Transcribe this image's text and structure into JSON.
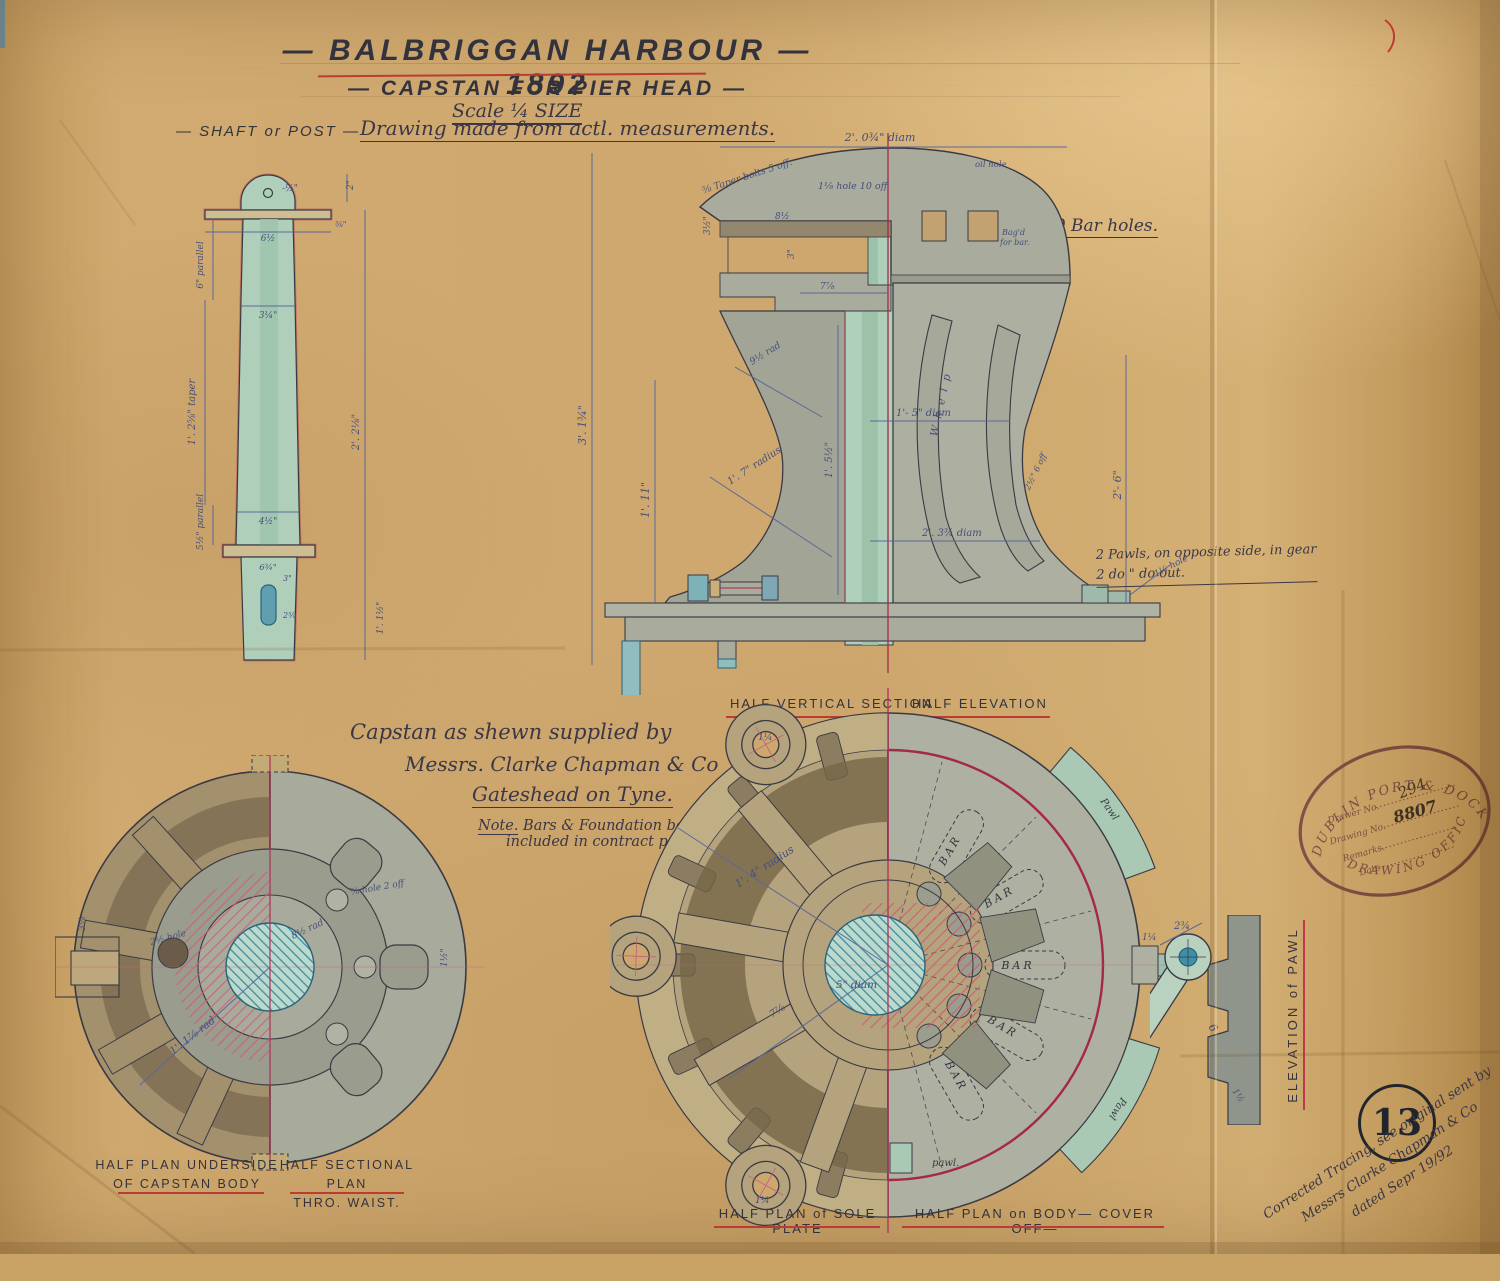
{
  "title_block": {
    "title": "— BALBRIGGAN  HARBOUR — 1892",
    "subtitle": "— CAPSTAN  FOR  PIER  HEAD —",
    "scale": "Scale ¼ SIZE"
  },
  "header": {
    "shaft_heading": "— SHAFT  or  POST —",
    "measurement_note": "Drawing made from actl. measurements.",
    "bar_holes": "10 Bar holes."
  },
  "shaft_view": {
    "dims": {
      "hole": "-½\"",
      "collar_width": "6½",
      "collar_thk": "⅜\"",
      "head_height": "2\"",
      "parallel_top": "6\" parallel",
      "dia_top": "3¼\"",
      "taper_length": "1'. 2⅝\" taper",
      "overall": "2'. 2⅛\"",
      "dia_bottom": "4½\"",
      "parallel_bottom": "5½\" parallel",
      "collar2_width": "6¾\"",
      "cotter_offset": "3\"",
      "cotter": "2⅝",
      "tail": "1'. 1½\""
    }
  },
  "section_view": {
    "label_left": "HALF VERTICAL SECTION",
    "label_right": "HALF ELEVATION",
    "ann": {
      "taper_bolts": "⅝ Taper bolts 5 off.",
      "hole10": "1⅛ hole 10 off",
      "oil_hole": "oil hole",
      "top_dia": "2'. 0¾\" diam",
      "plate": "8½",
      "chamber": "3\"",
      "lip": "3½\"",
      "depth": "7⅞",
      "bagd1": "Bag'd",
      "bagd2": "for bar.",
      "rad_waist": "9½ rad",
      "height_inner": "1'. 11\"",
      "height_overall": "3'. 1¾\"",
      "core": "1'. 5½\"",
      "dia_waist": "1'- 5\" diam",
      "whelp": "W h e l p",
      "whelp_w": "2½\" 6 off",
      "dia_base": "2'. 3¾ diam",
      "height_right": "2'- 6\"",
      "rad_base": "1'. 7\" radius",
      "hole_base": "1¼ hole",
      "pawls_line1": "2 Pawls, on opposite side, in gear",
      "pawls_line2": "2   do          \"          do   out."
    }
  },
  "supplier_note": {
    "line1": "Capstan as shewn supplied by",
    "line2": "Messrs. Clarke Chapman & Co",
    "line3": "Gateshead on Tyne.",
    "note_label": "Note.",
    "note_line1": " Bars & Foundation bolts not",
    "note_line2": "included in contract price."
  },
  "underside_plan": {
    "label_line1": "HALF PLAN UNDERSIDE",
    "label_line2": "OF CAPSTAN BODY",
    "label2_line1": "HALF SECTIONAL PLAN",
    "label2_line2": "THRO. WAIST.",
    "ann": {
      "hole_dark": "2½ hole",
      "hole2": "⅞ hole 2 off",
      "rad_outer": "1'. 1⅞ rad",
      "rad_inner": "8½ rad",
      "slot": "1½\"",
      "boss": "3⅛"
    }
  },
  "sole_plan": {
    "label_left": "HALF PLAN of SOLE PLATE",
    "label_right": "HALF PLAN on BODY— COVER OFF—",
    "ann": {
      "radius": "1'. 4\" radius",
      "shaft_dia": "5\" diam",
      "depth": "7⅞",
      "bar": "BAR",
      "pawl_rim": "Pawl",
      "pawl_small": "pawl.",
      "lobe_hole": "1¼",
      "boss_dim": "1¼"
    }
  },
  "pawl_view": {
    "label": "ELEVATION  of  PAWL",
    "ann": {
      "width": "2¾",
      "length": "6",
      "thk": "1½"
    }
  },
  "stamp": {
    "ring_top": "DUBLIN PORT & DOCKS BD",
    "ring_bottom": "DRAWING OFFICE",
    "field1_label": "Drawer No.",
    "field1_value": "294",
    "field2_label": "Drawing No.",
    "field2_value": "8807",
    "field3_label": "Remarks.",
    "field4_label": "Date"
  },
  "corner_note": {
    "line1": "Corrected Tracing, see original sent by",
    "line2": "Messrs Clarke Chapman & Co",
    "line3": "dated Sepr 19/92"
  },
  "sheet": {
    "number": "13"
  },
  "colors": {
    "paper": "#cda76d",
    "ink": "#34343f",
    "dim_blue": "#515e90",
    "red": "#bb3b35",
    "crimson": "#a52a4a",
    "teal": "#7fb2ad",
    "green_wash": "#b0cfba",
    "body_gray": "#a9ab9c",
    "sepia": "#a3916e",
    "stamp_purple": "#8b5a8f"
  }
}
